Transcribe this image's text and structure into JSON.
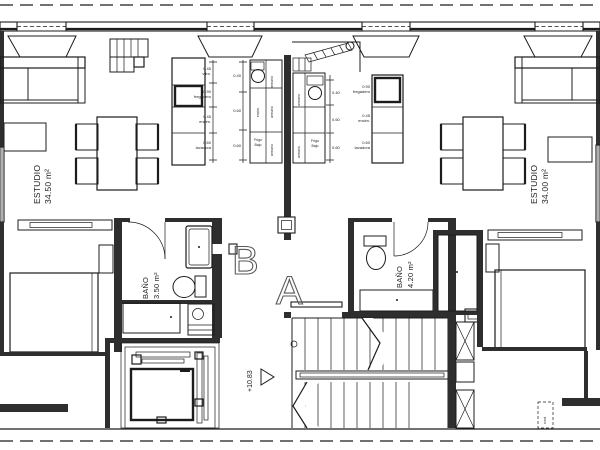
{
  "units": {
    "b": {
      "letter": "B",
      "room": "ESTUDIO",
      "area": "34.50 m²",
      "bath": "BAÑO",
      "bath_area": "3.50 m²"
    },
    "a": {
      "letter": "A",
      "room": "ESTUDIO",
      "area": "34.00 m²",
      "bath": "BAÑO",
      "bath_area": "4.20 m²"
    }
  },
  "stair": {
    "level": "+10.83"
  },
  "shafts": {
    "vent_label": "v.ext"
  },
  "kitchen_b": {
    "dims": [
      "0.45",
      "0.90",
      "0.45",
      "0.60"
    ],
    "dim_names": [
      "vitro.",
      "fregadero",
      "encim.",
      "lavadora"
    ],
    "widths": [
      "0.40",
      "0.60",
      "0.60"
    ],
    "cab": "armario",
    "counter": "encim.",
    "fridge1": "Frigo",
    "fridge2": "Bajo"
  },
  "kitchen_a": {
    "dims": [
      "0.90",
      "0.45",
      "0.60"
    ],
    "dim_names": [
      "fregadero",
      "encim.",
      "lavadora"
    ],
    "widths": [
      "0.40",
      "0.60",
      "0.60"
    ],
    "cab": "armario",
    "fridge1": "Frigo",
    "fridge2": "Bajo"
  },
  "colors": {
    "ink": "#1c1c1c",
    "wall": "#2e2e2e",
    "letter_outline": "#5a5a5a",
    "background": "#ffffff"
  }
}
